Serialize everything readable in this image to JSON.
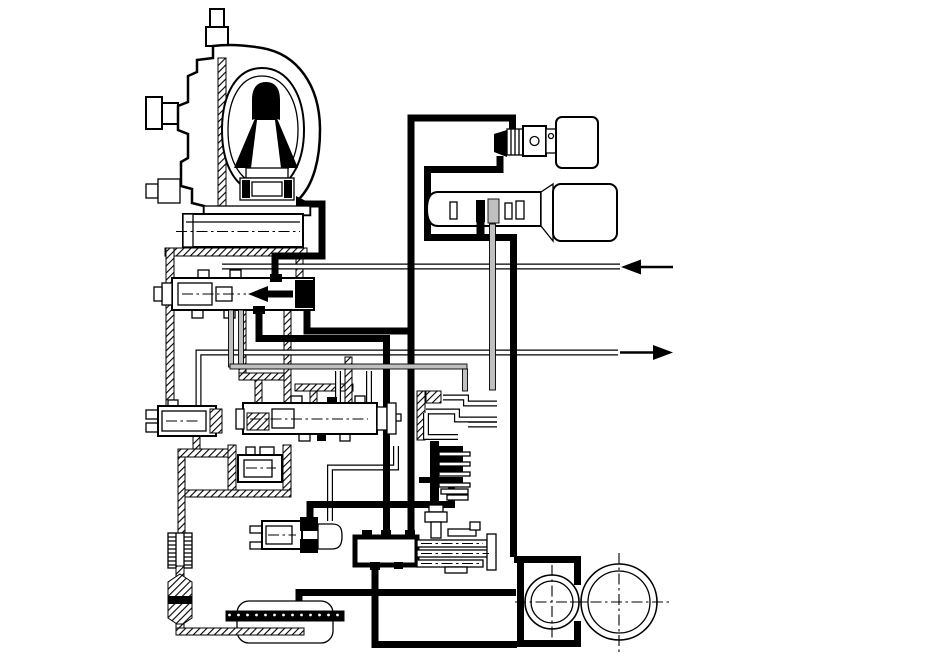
{
  "colors": {
    "ink": "#000000",
    "pipe_gray": "#c0c0c0",
    "background": "#ffffff"
  },
  "diagram": {
    "kind": "transmission-hydraulic-circuit-schematic",
    "has_text": false,
    "components": [
      {
        "id": "torque-converter"
      },
      {
        "id": "output-shaft-housing"
      },
      {
        "id": "pressure-regulator-valve"
      },
      {
        "id": "shift-valve-left"
      },
      {
        "id": "shift-valve-center"
      },
      {
        "id": "accumulator-valve"
      },
      {
        "id": "shift-solenoid-valve"
      },
      {
        "id": "lockup-solenoid"
      },
      {
        "id": "linear-solenoid"
      },
      {
        "id": "clutch-feed-channels"
      },
      {
        "id": "clutch-pack"
      },
      {
        "id": "manual-valve"
      },
      {
        "id": "oil-filter"
      },
      {
        "id": "oil-strainer"
      },
      {
        "id": "oil-pan"
      },
      {
        "id": "pump-housing"
      },
      {
        "id": "oil-pump-gears"
      }
    ],
    "flows": [
      {
        "id": "cooler-return-arrow",
        "direction": "left"
      },
      {
        "id": "cooler-feed-arrow",
        "direction": "right"
      }
    ],
    "line_styles": [
      {
        "id": "line-pressure",
        "style": "thick-black"
      },
      {
        "id": "oil-passage",
        "style": "diagonal-hatch"
      },
      {
        "id": "solenoid-signal",
        "style": "gray-filled"
      },
      {
        "id": "cooler-line",
        "style": "double-thin"
      }
    ]
  }
}
